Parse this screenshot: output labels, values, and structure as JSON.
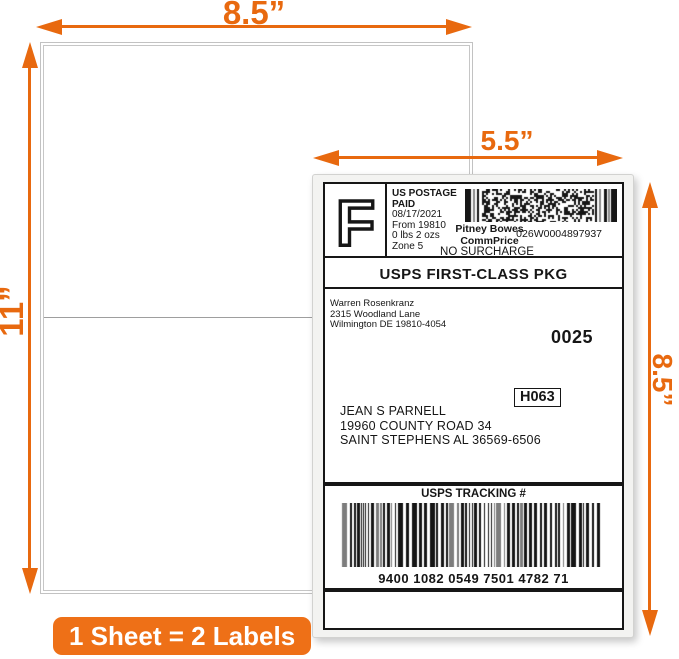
{
  "colors": {
    "accent_orange": "#E8690F",
    "badge_orange": "#EE7017",
    "label_ink": "#161616"
  },
  "dimensions": {
    "sheet_width": "8.5”",
    "sheet_height": "11”",
    "label_width": "5.5”",
    "label_height": "8.5”"
  },
  "badge": {
    "label": "1 Sheet = 2 Labels"
  },
  "shipping_label": {
    "indicia": {
      "letter": "F",
      "postage": [
        "US POSTAGE",
        "PAID"
      ],
      "details": [
        "08/17/2021",
        "From 19810",
        "0 lbs 2 ozs",
        "Zone 5"
      ],
      "carrier": [
        "Pitney Bowes",
        "CommPrice"
      ],
      "meter_id": "026W0004897937",
      "surcharge": "NO SURCHARGE"
    },
    "service": "USPS FIRST-CLASS PKG",
    "sender": [
      "Warren Rosenkranz",
      "2315 Woodland Lane",
      "Wilmington DE 19810-4054"
    ],
    "form_number": "0025",
    "carrier_route": "H063",
    "recipient": [
      "JEAN S PARNELL",
      "19960 COUNTY ROAD 34",
      "SAINT STEPHENS AL 36569-6506"
    ],
    "tracking_title": "USPS TRACKING #",
    "tracking_number": "9400 1082 0549 7501 4782 71"
  }
}
